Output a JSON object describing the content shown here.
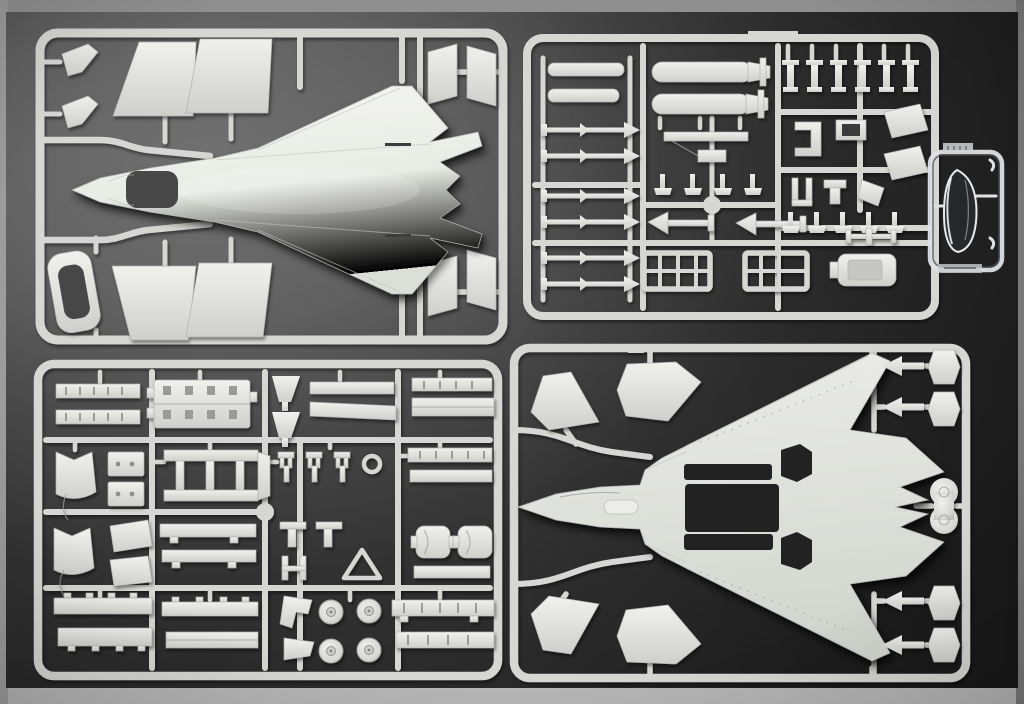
{
  "photo": {
    "subject": "Plastic model kit sprues",
    "description": "Overhead photo of a stealth-fighter scale model kit: four light-gray injection-molded sprues and one small clear canopy sprue laid on a dark charcoal mat",
    "sprues": [
      {
        "id": "A",
        "position": "top-left",
        "contents": [
          "upper fuselage with integral wings and cockpit opening",
          "outer wing panels x4",
          "vertical tail halves x4",
          "windscreen frame",
          "small stabilator darts x2"
        ]
      },
      {
        "id": "B",
        "position": "top-right",
        "contents": [
          "slender missile bodies x2",
          "guided bombs x2",
          "finned air-to-air missiles x6",
          "weapon pylons x6",
          "launch rail parts",
          "arrow-finned missiles x2",
          "weapon-bay racks x2",
          "engine block part",
          "assorted small fittings"
        ]
      },
      {
        "id": "CLEAR",
        "position": "middle-right",
        "contents": [
          "clear cockpit canopy"
        ]
      },
      {
        "id": "C",
        "position": "bottom-left",
        "contents": [
          "ribbed weapon-bay interior panel",
          "bay door strips with hinge bumps",
          "intake duct halves x2",
          "ladder-style door assembly",
          "landing-gear wheels x4",
          "gear struts, brackets and actuators"
        ]
      },
      {
        "id": "D",
        "position": "bottom-right",
        "contents": [
          "lower fuselage with open weapon bays",
          "tail fin halves x4",
          "exhaust petal arrows x4",
          "nozzle pods x4",
          "twin-wheel hub part"
        ]
      }
    ],
    "colors": {
      "plastic_base": "#d6d6d2",
      "plastic_bright": "#eef0ec",
      "plastic_shadow": "#a9a9a5",
      "clear_part_rim": "#dde2e6",
      "canopy_tint": "#26282a",
      "cockpit_opening": "#474747",
      "bay_opening": "#202020",
      "mat_dark": "#242424",
      "mat_light": "#6e6e6e",
      "table_top_edge": "#8f8f8f",
      "table_bottom_edge": "#b5b5b5",
      "table_left_edge": "#9c9c9c",
      "table_right_edge": "#787878"
    }
  }
}
